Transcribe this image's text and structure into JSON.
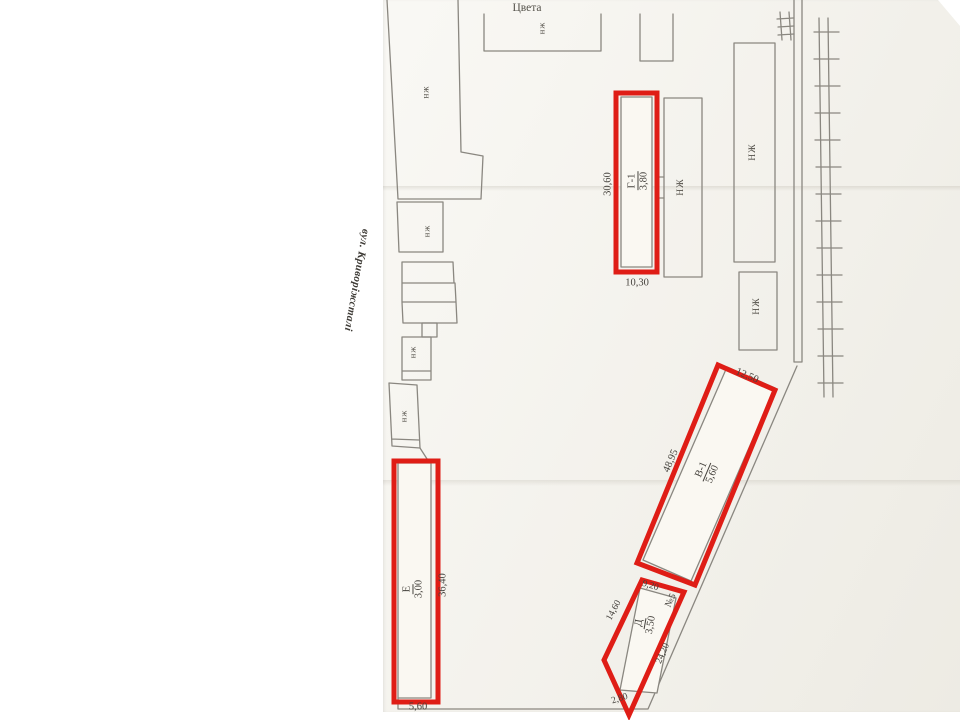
{
  "title": "Цвета",
  "street": "вул. Криворіжсталі",
  "label_nzh": "нж",
  "label_nzh_caps": "НЖ",
  "g1": {
    "code": "Г-1",
    "h": "3,80",
    "len": "30,60",
    "wid": "10,30"
  },
  "v1": {
    "code": "В-1",
    "h": "5,60",
    "len": "48,95",
    "wid": "12,50"
  },
  "e": {
    "code": "Е",
    "h": "3,00",
    "len": "36,40",
    "wid": "5,60"
  },
  "d": {
    "code": "Д",
    "h": "3,50",
    "left": "14,60",
    "top": "9,20",
    "plot": "№5",
    "bottom": "2,80",
    "diag": "24,20"
  },
  "colors": {
    "highlight": "#df1d16",
    "line": "#8a8780",
    "text": "#45423d",
    "paper": "#f5f3ec"
  }
}
